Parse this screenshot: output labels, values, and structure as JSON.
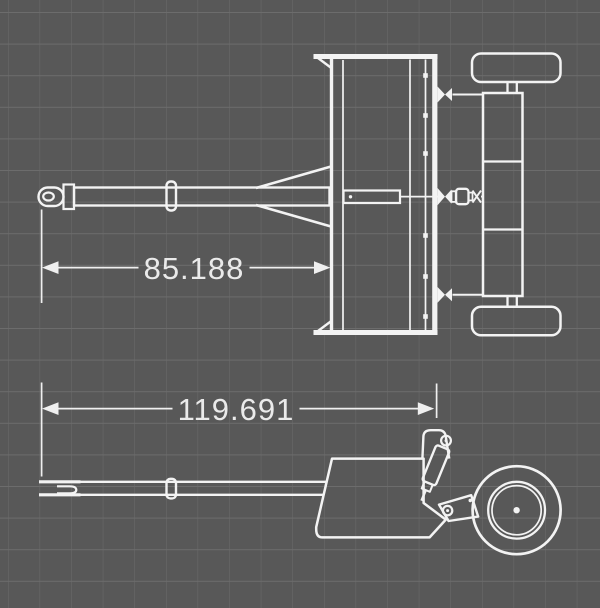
{
  "drawing": {
    "title_visible_text": "",
    "views": {
      "top_view_name": "plan-view-of-implement",
      "side_view_name": "side-view-of-implement"
    }
  },
  "dimensions": {
    "top": {
      "value": "85.188"
    },
    "side": {
      "value": "119.691"
    }
  },
  "icons": {
    "dimension_arrow_left": "◀",
    "dimension_arrow_right": "▶"
  },
  "colors": {
    "background": "#585858",
    "grid_line": "#6c6c6c",
    "drawing_line": "#f3f3f3",
    "dimension_line": "#efefef",
    "dimension_text": "#eaeaea"
  }
}
